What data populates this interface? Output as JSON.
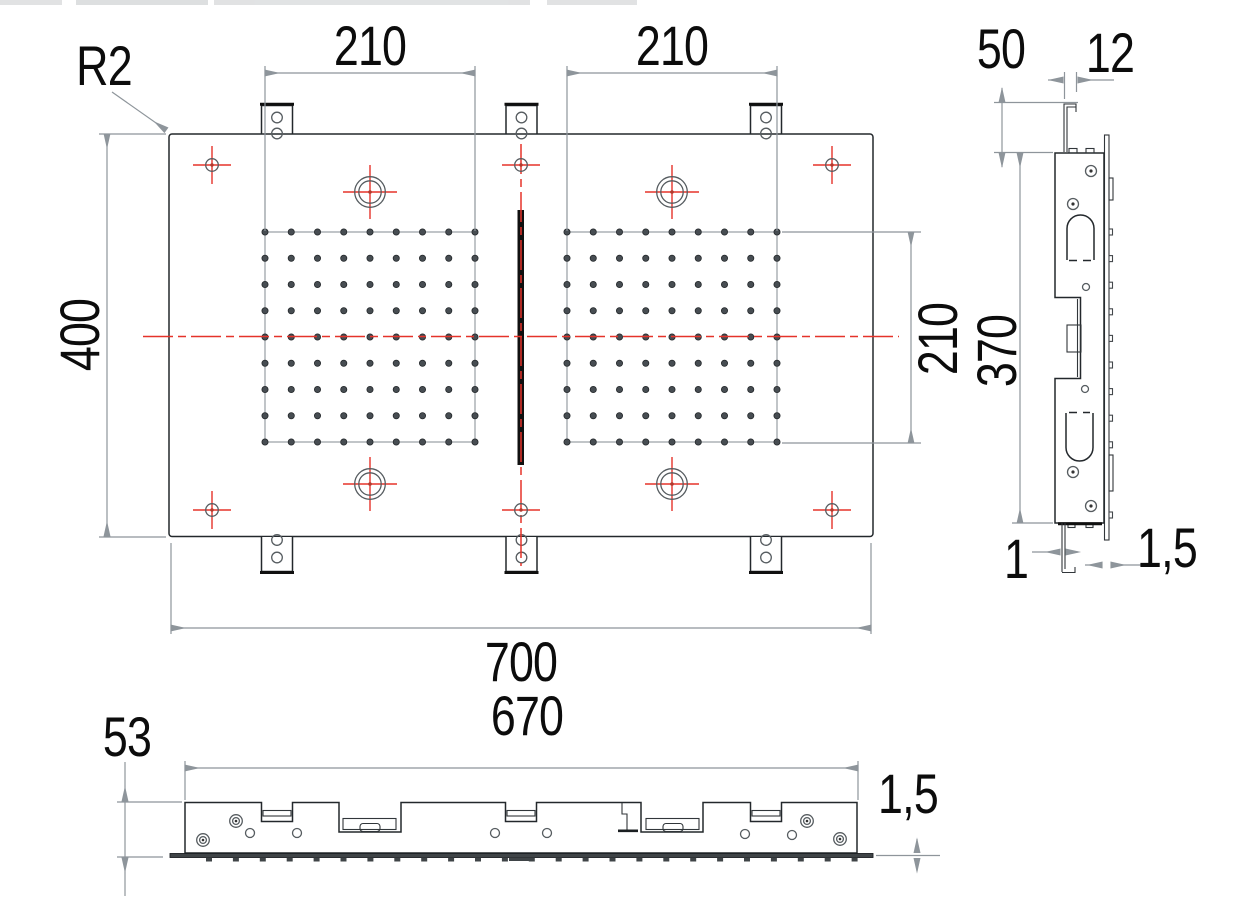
{
  "drawing": {
    "name": "flat-panel-technical-drawing",
    "front_view": {
      "corner_radius_label": "R2",
      "dim_top_left": "210",
      "dim_top_right": "210",
      "dim_height": "400",
      "dim_width": "700",
      "dim_grid_height": "210"
    },
    "side_view": {
      "dim_hook_offset": "50",
      "dim_hook_width": "12",
      "dim_frame_height": "370",
      "dim_hook_thickness": "1",
      "dim_face_thickness": "1,5"
    },
    "bottom_view": {
      "dim_profile_height": "53",
      "dim_inner_width": "670",
      "dim_plate_thickness": "1,5"
    },
    "colors": {
      "part_line": "#23282c",
      "dimension_line": "#8e959b",
      "centerline_red": "#e5332a",
      "background": "#ffffff"
    }
  }
}
